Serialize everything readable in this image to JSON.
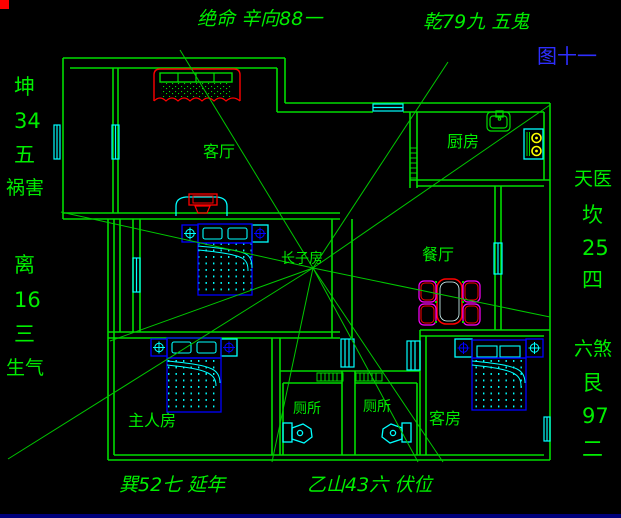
{
  "colors": {
    "background": "#000000",
    "wall_green": "#00dc00",
    "text_green": "#00ee00",
    "window_cyan": "#00ffff",
    "furniture_blue": "#0000ff",
    "accent_red": "#ff0000",
    "chair_magenta": "#ff00ff",
    "burner_yellow": "#ffff00",
    "figure_blue": "#2e2eff"
  },
  "annotations": {
    "top": [
      "绝命 辛向88一",
      "乾79九 五鬼"
    ],
    "figure_label": "图十一",
    "left": [
      "坤",
      "34",
      "五",
      "祸害",
      "离",
      "16",
      "三",
      "生气"
    ],
    "right": [
      "天医",
      "坎",
      "25",
      "四",
      "六煞",
      "艮",
      "97",
      "二"
    ],
    "bottom": [
      "巽52七 延年",
      "乙山43六 伏位"
    ]
  },
  "rooms": {
    "living": "客厅",
    "kitchen": "厨房",
    "dining": "餐厅",
    "eldest_son": "长子房",
    "master": "主人房",
    "toilet_left": "厕所",
    "toilet_right": "厕所",
    "guest": "客房"
  }
}
